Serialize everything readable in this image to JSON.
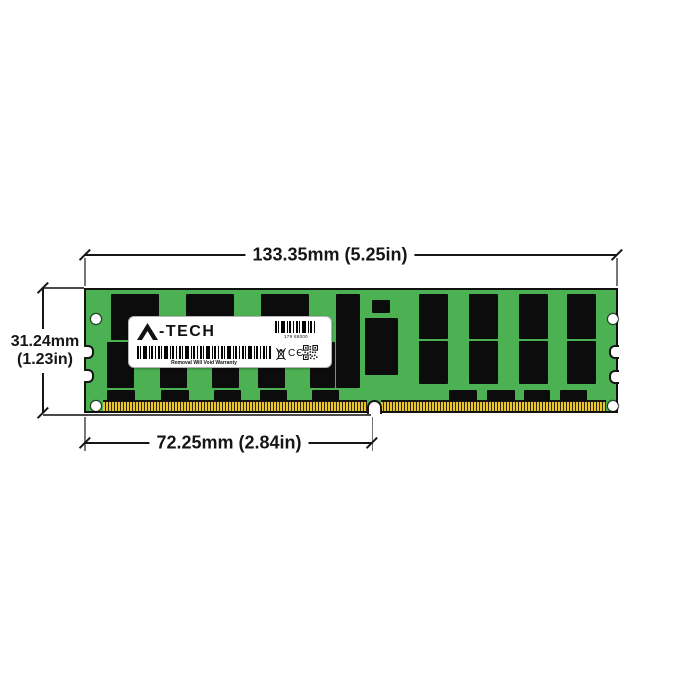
{
  "dimensions": {
    "top": "133.35mm (5.25in)",
    "left_line1": "31.24mm",
    "left_line2": "(1.23in)",
    "bottom": "72.25mm (2.84in)"
  },
  "label": {
    "brand": "A-TECH",
    "serial": "179 88000",
    "warranty": "Removal Will Void Warranty",
    "ce_mark": "CЄ"
  },
  "icons": {
    "brand_triangle": "solid-triangle-A",
    "barcode_small": "css-stripes",
    "barcode_long": "css-stripes",
    "weee_bin": "crossed-out-wheelie-bin",
    "qr_code": "svg-grid",
    "mounting_hole": "white-circle"
  },
  "colors": {
    "pcb_green": "#4cb153",
    "chip_black": "#0c0c0c",
    "pin_gold": "#e8c52f",
    "line_ink": "#161616",
    "extension_gray": "#777777",
    "label_white": "#ffffff"
  },
  "module": {
    "chips": [
      {
        "x": 25,
        "y": 4,
        "w": 48,
        "h": 46
      },
      {
        "x": 100,
        "y": 4,
        "w": 48,
        "h": 46
      },
      {
        "x": 175,
        "y": 4,
        "w": 48,
        "h": 46
      },
      {
        "x": 250,
        "y": 4,
        "w": 24,
        "h": 94
      },
      {
        "x": 21,
        "y": 52,
        "w": 27,
        "h": 46
      },
      {
        "x": 74,
        "y": 52,
        "w": 27,
        "h": 46
      },
      {
        "x": 126,
        "y": 52,
        "w": 27,
        "h": 46
      },
      {
        "x": 172,
        "y": 52,
        "w": 27,
        "h": 46
      },
      {
        "x": 224,
        "y": 52,
        "w": 25,
        "h": 46
      },
      {
        "x": 286,
        "y": 10,
        "w": 18,
        "h": 13
      },
      {
        "x": 279,
        "y": 28,
        "w": 33,
        "h": 57
      },
      {
        "x": 333,
        "y": 4,
        "w": 29,
        "h": 45
      },
      {
        "x": 383,
        "y": 4,
        "w": 29,
        "h": 45
      },
      {
        "x": 433,
        "y": 4,
        "w": 29,
        "h": 45
      },
      {
        "x": 481,
        "y": 4,
        "w": 29,
        "h": 45
      },
      {
        "x": 333,
        "y": 51,
        "w": 29,
        "h": 43
      },
      {
        "x": 383,
        "y": 51,
        "w": 29,
        "h": 43
      },
      {
        "x": 433,
        "y": 51,
        "w": 29,
        "h": 43
      },
      {
        "x": 481,
        "y": 51,
        "w": 29,
        "h": 43
      },
      {
        "x": 21,
        "y": 100,
        "w": 28,
        "h": 11
      },
      {
        "x": 75,
        "y": 100,
        "w": 28,
        "h": 11
      },
      {
        "x": 128,
        "y": 100,
        "w": 27,
        "h": 11
      },
      {
        "x": 174,
        "y": 100,
        "w": 27,
        "h": 11
      },
      {
        "x": 226,
        "y": 100,
        "w": 27,
        "h": 11
      },
      {
        "x": 363,
        "y": 100,
        "w": 28,
        "h": 11
      },
      {
        "x": 401,
        "y": 100,
        "w": 28,
        "h": 11
      },
      {
        "x": 438,
        "y": 100,
        "w": 26,
        "h": 11
      },
      {
        "x": 474,
        "y": 100,
        "w": 27,
        "h": 11
      }
    ],
    "holes": [
      {
        "cx": 10,
        "cy": 29
      },
      {
        "cx": 10,
        "cy": 116
      },
      {
        "cx": 527,
        "cy": 29
      },
      {
        "cx": 527,
        "cy": 116
      }
    ],
    "side_notches": [
      {
        "side": "left",
        "y": 55
      },
      {
        "side": "left",
        "y": 79
      },
      {
        "side": "right",
        "y": 55
      },
      {
        "side": "right",
        "y": 80
      }
    ],
    "pin_strips": [
      {
        "x": 17,
        "w": 264
      },
      {
        "x": 295,
        "w": 225
      }
    ],
    "key_notch_x": 281
  }
}
